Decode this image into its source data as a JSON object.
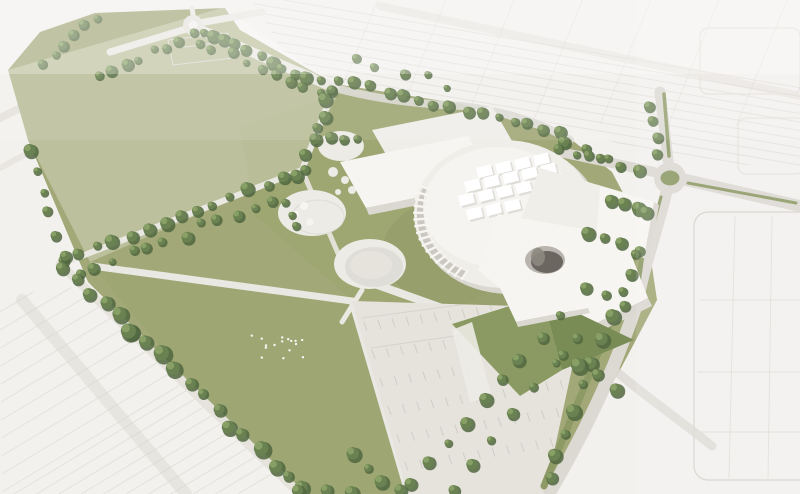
{
  "meta": {
    "description": "Aerial 3D rendering of a cultural-campus masterplan: a white circular event hall with rooftop skylights and rectangular exhibition halls sits in a sage-green park with circular plazas, tree-lined paths, a great lawn with a bird flock, a striped parking lot, a tree-lined boulevard, a road with a roundabout on the east side, and faint white city blocks fading into haze around the site.",
    "width": 800,
    "height": 494
  },
  "elements": [
    "context-city-blocks",
    "park-fields",
    "tree-rows",
    "event-hall-drum",
    "exhibition-halls",
    "angular-wing",
    "green-roof-wedge",
    "circular-plazas",
    "great-lawn",
    "bird-flock",
    "parking-lot",
    "roundabout",
    "roads-and-medians",
    "small-court-building"
  ],
  "palette": {
    "bg_top": "#f3f1ee",
    "ctx_fill": "#efede9",
    "ctx_line": "#d5d2cb",
    "road": "#dcd9d3",
    "road_light": "#e6e3dd",
    "path": "#eae8e2",
    "plaza": "#ecebe5",
    "lawn": "#a2a877",
    "lawn_bright": "#99a36d",
    "verge": "#8e9a66",
    "green_roof": "#8a9a62",
    "green_roof_dark": "#798c55",
    "tree_dark": "#50663f",
    "tree_mid": "#6a8251",
    "tree_light": "#8ca368",
    "bldg_white": "#f7f5f1",
    "bldg_roof": "#f0eee9",
    "bldg_shade": "#dbd8d2",
    "bldg_dark": "#c8c5bf",
    "fin_shade": "#c6c3bd",
    "hole_rim": "#b9b5ae",
    "hole_dark": "#6b665f",
    "hole_light": "#8d8881",
    "lawn_shadow": "#6f7a4e",
    "bird": "#f8f7f3",
    "stripe": "#c9c6c0",
    "lane": "#d3d0ca"
  },
  "scene": {
    "tree_rows": [
      [
        96,
        16,
        42,
        64,
        6,
        4.5,
        6
      ],
      [
        205,
        30,
        98,
        74,
        9,
        5,
        7
      ],
      [
        210,
        34,
        332,
        88,
        11,
        5.5,
        6
      ],
      [
        198,
        42,
        320,
        94,
        9,
        4.5,
        8
      ],
      [
        332,
        88,
        302,
        168,
        7,
        5.5,
        6
      ],
      [
        340,
        80,
        560,
        133,
        15,
        5,
        7
      ],
      [
        565,
        141,
        602,
        159,
        3,
        6,
        5
      ],
      [
        352,
        60,
        450,
        84,
        5,
        4,
        8
      ],
      [
        298,
        172,
        64,
        262,
        15,
        5.5,
        8
      ],
      [
        268,
        200,
        80,
        272,
        12,
        5,
        9
      ],
      [
        32,
        148,
        62,
        258,
        6,
        5.5,
        7
      ],
      [
        64,
        266,
        132,
        330,
        6,
        6.5,
        7
      ],
      [
        132,
        330,
        300,
        490,
        13,
        7,
        8
      ],
      [
        300,
        490,
        352,
        494,
        3,
        6,
        6
      ],
      [
        350,
        455,
        398,
        492,
        4,
        6,
        6
      ],
      [
        408,
        486,
        558,
        314,
        9,
        5.5,
        6
      ],
      [
        452,
        488,
        576,
        336,
        7,
        5,
        6
      ],
      [
        610,
        318,
        548,
        478,
        8,
        6,
        7
      ],
      [
        612,
        198,
        648,
        212,
        4,
        6,
        5
      ],
      [
        588,
        232,
        640,
        248,
        4,
        6.5,
        5
      ],
      [
        586,
        288,
        624,
        304,
        3,
        6,
        5
      ],
      [
        558,
        148,
        638,
        168,
        6,
        5,
        6
      ],
      [
        648,
        106,
        658,
        152,
        4,
        4.5,
        5
      ],
      [
        330,
        137,
        356,
        139,
        3,
        5,
        4
      ],
      [
        286,
        202,
        296,
        226,
        3,
        5,
        4
      ],
      [
        560,
        352,
        614,
        388,
        4,
        6.5,
        6
      ],
      [
        636,
        252,
        624,
        292,
        3,
        5.5,
        5
      ]
    ],
    "fans": [
      {
        "name": "context-row-line",
        "seg": [
          248,
          -6,
          330,
          128
        ],
        "n": 15,
        "dir": [
          565,
          96
        ],
        "c": "ctx_line",
        "w": 1,
        "o": 0.5,
        "clip": "ctr"
      },
      {
        "name": "context-cross-street",
        "seg": [
          380,
          -6,
          788,
          -2
        ],
        "n": 7,
        "dir": [
          -52,
          128
        ],
        "c": "ctx_line",
        "w": 1,
        "o": 0.35,
        "clip": "ctr"
      },
      {
        "name": "context-row-line",
        "seg": [
          0,
          312,
          2,
          492
        ],
        "n": 11,
        "dir": [
          330,
          -198
        ],
        "c": "ctx_line",
        "w": 1,
        "o": 0.5,
        "clip": "cbl"
      },
      {
        "name": "context-row-line",
        "seg": [
          14,
          494,
          238,
          494
        ],
        "n": 11,
        "dir": [
          330,
          -198
        ],
        "c": "ctx_line",
        "w": 1,
        "o": 0.5,
        "clip": "cbl"
      },
      {
        "name": "parking-stall-stripe",
        "seg": [
          364,
          322,
          560,
          296
        ],
        "n": 15,
        "dir": [
          3,
          9
        ],
        "c": "stripe",
        "w": 1,
        "o": 0.75,
        "clip": "clot"
      },
      {
        "name": "parking-stall-stripe",
        "seg": [
          372,
          350,
          570,
          322
        ],
        "n": 15,
        "dir": [
          3,
          9
        ],
        "c": "stripe",
        "w": 1,
        "o": 0.75,
        "clip": "clot"
      },
      {
        "name": "parking-stall-stripe",
        "seg": [
          380,
          378,
          566,
          350
        ],
        "n": 14,
        "dir": [
          3,
          9
        ],
        "c": "stripe",
        "w": 1,
        "o": 0.75,
        "clip": "clot"
      },
      {
        "name": "parking-stall-stripe",
        "seg": [
          388,
          406,
          560,
          380
        ],
        "n": 13,
        "dir": [
          3,
          9
        ],
        "c": "stripe",
        "w": 1,
        "o": 0.75,
        "clip": "clot"
      },
      {
        "name": "parking-stall-stripe",
        "seg": [
          397,
          434,
          556,
          408
        ],
        "n": 12,
        "dir": [
          3,
          9
        ],
        "c": "stripe",
        "w": 1,
        "o": 0.75,
        "clip": "clot"
      },
      {
        "name": "parking-stall-stripe",
        "seg": [
          405,
          462,
          550,
          438
        ],
        "n": 11,
        "dir": [
          3,
          9
        ],
        "c": "stripe",
        "w": 1,
        "o": 0.75,
        "clip": "clot"
      }
    ],
    "lines": [
      {
        "p": [
          700,
          300,
          808,
          300
        ],
        "c": "ctx_line",
        "w": 1,
        "o": 0.55,
        "layer": "ctx-lines",
        "name": "block-grid-line"
      },
      {
        "p": [
          698,
          372,
          806,
          372
        ],
        "c": "ctx_line",
        "w": 1,
        "o": 0.55,
        "layer": "ctx-lines",
        "name": "block-grid-line"
      },
      {
        "p": [
          700,
          432,
          806,
          432
        ],
        "c": "ctx_line",
        "w": 1,
        "o": 0.55,
        "layer": "ctx-lines",
        "name": "block-grid-line"
      },
      {
        "p": [
          735,
          216,
          729,
          478
        ],
        "c": "ctx_line",
        "w": 1,
        "o": 0.55,
        "layer": "ctx-lines",
        "name": "block-grid-line"
      },
      {
        "p": [
          772,
          216,
          768,
          478
        ],
        "c": "ctx_line",
        "w": 1,
        "o": 0.55,
        "layer": "ctx-lines",
        "name": "block-grid-line"
      },
      {
        "p": [
          362,
          318,
          556,
          292
        ],
        "c": "lane",
        "w": 1,
        "o": 0.8,
        "layer": "lot-stripes",
        "name": "parking-lane-line"
      },
      {
        "p": [
          371,
          348,
          566,
          320
        ],
        "c": "lane",
        "w": 1,
        "o": 0.8,
        "layer": "lot-stripes",
        "name": "parking-lane-line"
      },
      {
        "p": [
          664,
          94,
          669,
          156
        ],
        "c": "verge",
        "w": 3.5,
        "o": 1,
        "layer": "medians",
        "name": "green-median"
      },
      {
        "p": [
          688,
          183,
          796,
          203
        ],
        "c": "verge",
        "w": 3,
        "o": 1,
        "layer": "medians",
        "name": "green-median"
      },
      {
        "p": [
          661,
          197,
          648,
          246
        ],
        "c": "verge",
        "w": 3,
        "o": 1,
        "layer": "medians",
        "name": "green-median"
      }
    ],
    "fins": {
      "cx": 504,
      "cy": 214,
      "rx": 90,
      "ry": 74,
      "a1": 118,
      "a2": 202,
      "n": 17
    },
    "skylights": {
      "starts": [
        [
          476,
          168
        ],
        [
          464,
          182
        ],
        [
          458,
          196
        ],
        [
          466,
          210
        ]
      ],
      "counts": [
        4,
        5,
        4,
        3
      ],
      "col": [
        19,
        -4
      ],
      "w": 15,
      "h": 10.5,
      "rot": -14
    },
    "birds": {
      "cx": 276,
      "cy": 346,
      "n": 16,
      "sx": 56,
      "sy": 34
    },
    "plaza_circles": [
      [
        333,
        172,
        5
      ],
      [
        345,
        180,
        4
      ],
      [
        356,
        172,
        3.5
      ],
      [
        366,
        180,
        3
      ],
      [
        352,
        190,
        4
      ],
      [
        338,
        192,
        3
      ],
      [
        364,
        193,
        2.5
      ],
      [
        375,
        186,
        2.5
      ],
      [
        347,
        163,
        3
      ]
    ]
  }
}
